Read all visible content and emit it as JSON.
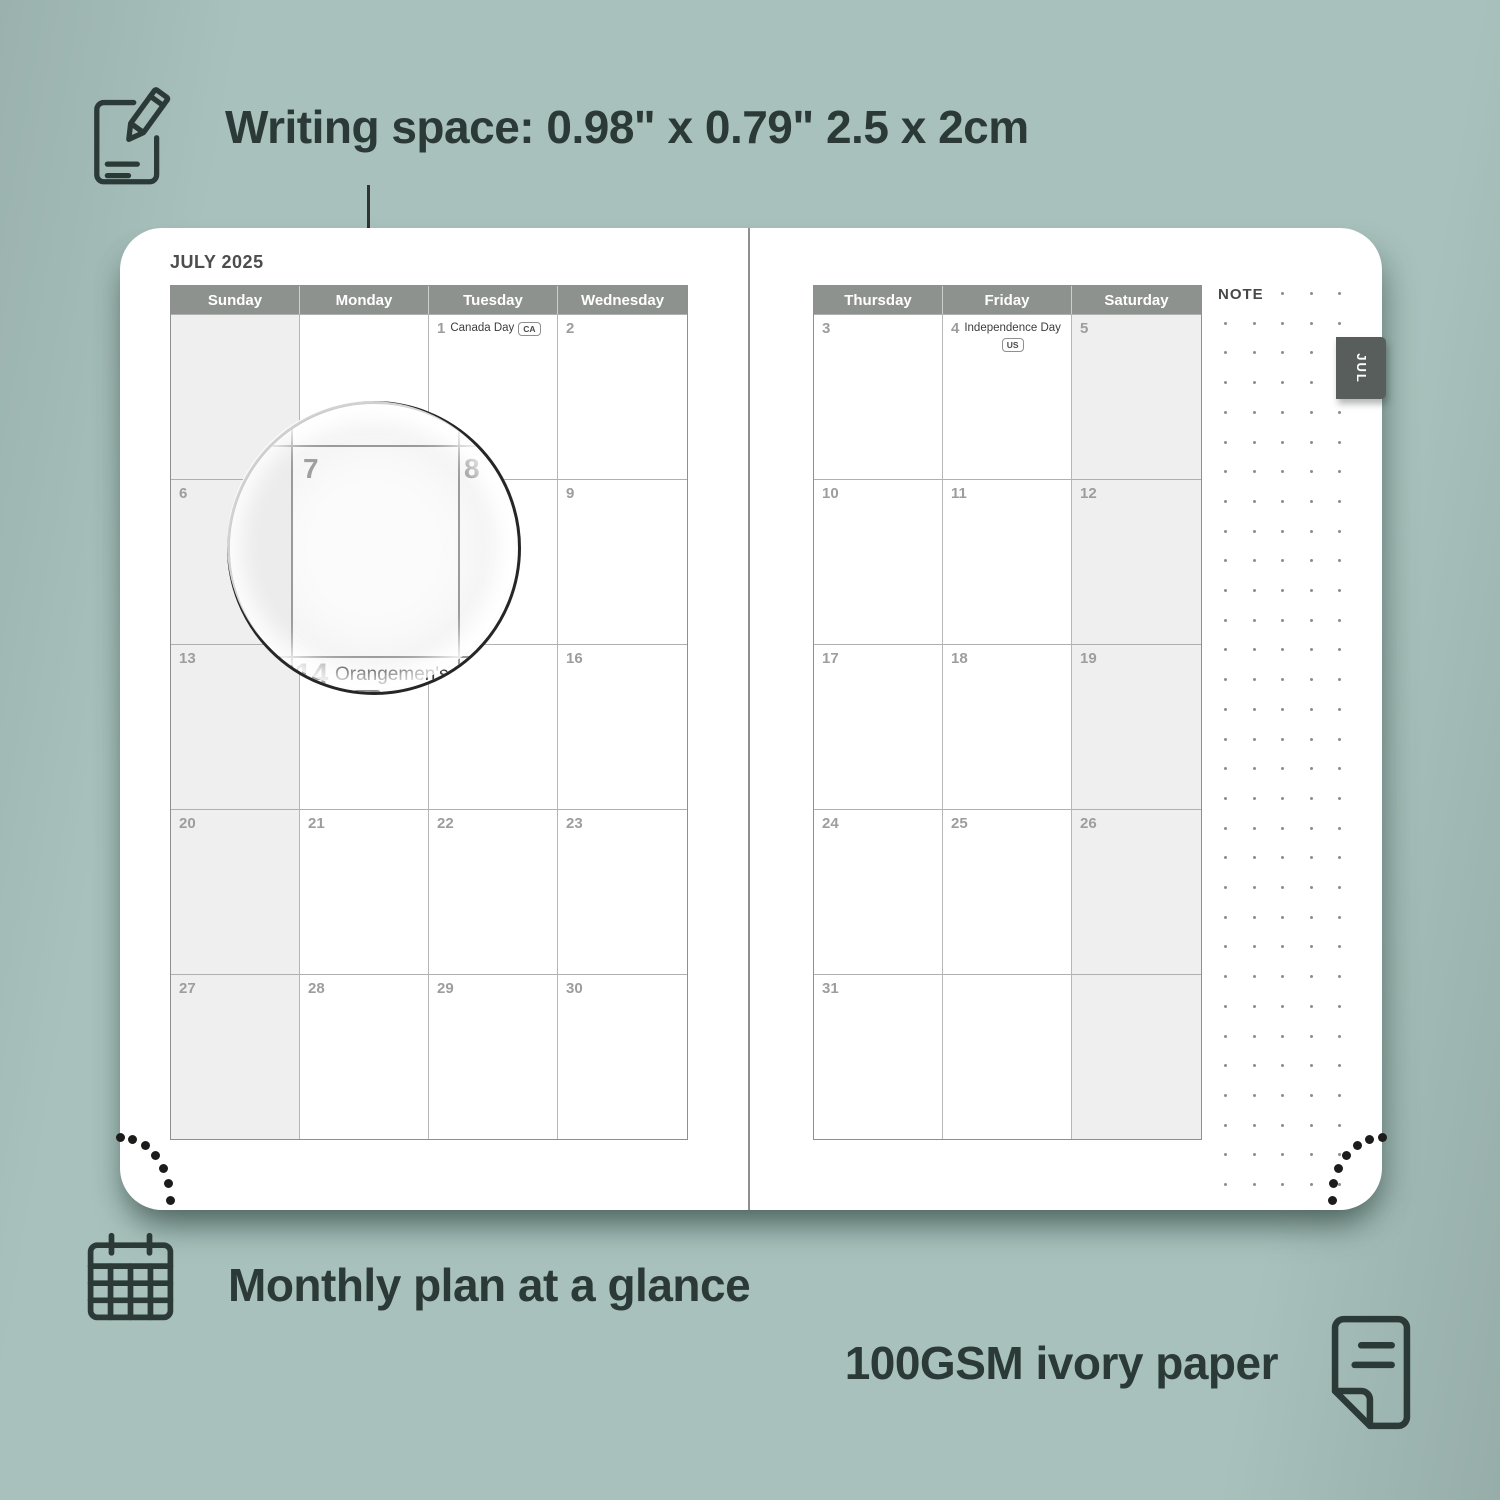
{
  "hero": {
    "writing_space_text": "Writing space: 0.98\" x 0.79\" 2.5 x 2cm",
    "monthly_plan_text": "Monthly plan at a glance",
    "paper_text": "100GSM ivory paper"
  },
  "planner": {
    "month_title": "JULY 2025",
    "edge_tab_label": "JUL",
    "note_label": "NOTE",
    "left_page": {
      "day_headers": [
        "Sunday",
        "Monday",
        "Tuesday",
        "Wednesday"
      ],
      "shaded_column": 0,
      "weeks": [
        [
          {},
          {},
          {
            "day": "1",
            "holiday": "Canada Day",
            "badge": "CA",
            "badge_layout": "inline"
          },
          {
            "day": "2"
          }
        ],
        [
          {
            "day": "6"
          },
          {
            "day": "7"
          },
          {
            "day": "8"
          },
          {
            "day": "9"
          }
        ],
        [
          {
            "day": "13"
          },
          {
            "day": "14",
            "holiday": "Orangemen's Day",
            "badge": "NL",
            "badge_layout": "below"
          },
          {
            "day": "15"
          },
          {
            "day": "16"
          }
        ],
        [
          {
            "day": "20"
          },
          {
            "day": "21"
          },
          {
            "day": "22"
          },
          {
            "day": "23"
          }
        ],
        [
          {
            "day": "27"
          },
          {
            "day": "28"
          },
          {
            "day": "29"
          },
          {
            "day": "30"
          }
        ]
      ]
    },
    "right_page": {
      "day_headers": [
        "Thursday",
        "Friday",
        "Saturday"
      ],
      "shaded_column": 2,
      "weeks": [
        [
          {
            "day": "3"
          },
          {
            "day": "4",
            "holiday": "Independence Day",
            "badge": "US",
            "badge_layout": "below"
          },
          {
            "day": "5"
          }
        ],
        [
          {
            "day": "10"
          },
          {
            "day": "11"
          },
          {
            "day": "12"
          }
        ],
        [
          {
            "day": "17"
          },
          {
            "day": "18"
          },
          {
            "day": "19"
          }
        ],
        [
          {
            "day": "24"
          },
          {
            "day": "25"
          },
          {
            "day": "26"
          }
        ],
        [
          {
            "day": "31"
          },
          {},
          {}
        ]
      ]
    }
  },
  "magnifier": {
    "zoomed_day": "7",
    "adjacent_day": "8",
    "below_day": "14",
    "below_holiday": "Orangemen's Day",
    "below_badge": "NL"
  },
  "colors": {
    "background": "#a8c1bc",
    "ink": "#2b3a37",
    "header_bar": "#8e928f",
    "weekend_shade": "#efefef",
    "tab_background": "#585e5b",
    "date_number": "#9d9d9d"
  }
}
